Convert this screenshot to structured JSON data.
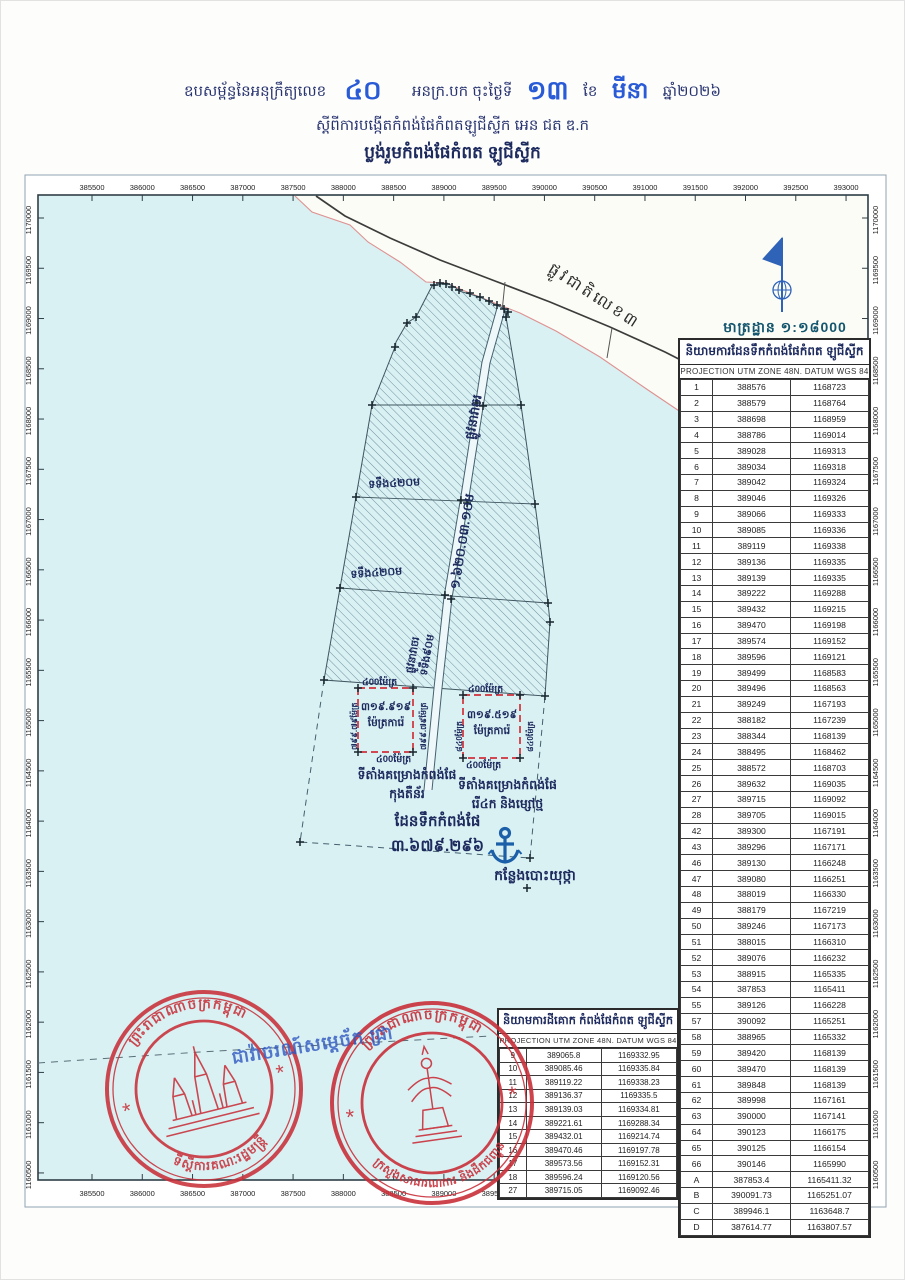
{
  "header": {
    "line1_prefix": "ឧបសម្ព័ន្ធនៃអនុក្រឹត្យលេខ",
    "decree_no": "៤០",
    "line1_mid": "អនក្រ.បក ចុះថ្ងៃទី",
    "day": "១៣",
    "month_label": "ខែ",
    "month": "មីនា",
    "year": "ឆ្នាំ២០២៦",
    "line2": "ស្តីពីការបង្កើតកំពង់ផែកំពតឡូជីស្ទីក អេន ជត ឌ.ក",
    "line3": "ប្លង់រួមកំពង់ផែកំពត ឡូជីស្ទីក"
  },
  "map": {
    "scale_label": "មាត្រដ្ឋាន ១:១៨000",
    "road_label": "ផ្លូវជាតិលេខ៣",
    "channel_label_top": "ផ្លូវនាវាចរ",
    "channel_label_mid": "១.៦២០.០៣.១០ម",
    "channel_label_bottom1": "ផ្លូវនាវាចរ",
    "channel_label_bottom2": "ទទឹង៩០ម",
    "width_label_1": "ទទឹង៤២០ម",
    "width_label_2": "ទទឹង៤២០ម",
    "water_area_line1": "ដែនទឹកកំពង់ផែ",
    "water_area_line2": "៣.៦៧៩.២៩៦",
    "anchorage_label": "កន្លែងបោះយុថ្កា"
  },
  "parcels": {
    "left": {
      "top": "៤00ម៉ែត្រ",
      "bottom": "៤00ម៉ែត្រ",
      "side_left": "៧៩៩.៧៩ម៉ែត្រ",
      "side_right": "៧៩៩.៧៩ម៉ែត្រ",
      "area": "៣១៩.៩១៩",
      "unit": "ម៉ែត្រការ៉េ",
      "caption1": "ទីតាំងគម្រោងកំពង់ផែ",
      "caption2": "កុងតឺន័រ"
    },
    "right": {
      "top": "៤00ម៉ែត្រ",
      "bottom": "៤00ម៉ែត្រ",
      "side_left": "៨៤0ម៉ែត្រ",
      "side_right": "៨៤0ម៉ែត្រ",
      "area": "៣១៩.៥១៩",
      "unit": "ម៉ែត្រការ៉េ",
      "caption1": "ទីតាំងគម្រោងកំពង់ផែ",
      "caption2": "រើ៤ក និងម្សៅថ្ម"
    }
  },
  "water_table": {
    "title": "និយាមការដែនទឹកកំពង់ផែកំពត ឡូជីស្ទីក",
    "subtitle": "PROJECTION UTM ZONE 48N. DATUM WGS 84",
    "rows": [
      [
        "1",
        "388576",
        "1168723"
      ],
      [
        "2",
        "388579",
        "1168764"
      ],
      [
        "3",
        "388698",
        "1168959"
      ],
      [
        "4",
        "388786",
        "1169014"
      ],
      [
        "5",
        "389028",
        "1169313"
      ],
      [
        "6",
        "389034",
        "1169318"
      ],
      [
        "7",
        "389042",
        "1169324"
      ],
      [
        "8",
        "389046",
        "1169326"
      ],
      [
        "9",
        "389066",
        "1169333"
      ],
      [
        "10",
        "389085",
        "1169336"
      ],
      [
        "11",
        "389119",
        "1169338"
      ],
      [
        "12",
        "389136",
        "1169335"
      ],
      [
        "13",
        "389139",
        "1169335"
      ],
      [
        "14",
        "389222",
        "1169288"
      ],
      [
        "15",
        "389432",
        "1169215"
      ],
      [
        "16",
        "389470",
        "1169198"
      ],
      [
        "17",
        "389574",
        "1169152"
      ],
      [
        "18",
        "389596",
        "1169121"
      ],
      [
        "19",
        "389499",
        "1168583"
      ],
      [
        "20",
        "389496",
        "1168563"
      ],
      [
        "21",
        "389249",
        "1167193"
      ],
      [
        "22",
        "388182",
        "1167239"
      ],
      [
        "23",
        "388344",
        "1168139"
      ],
      [
        "24",
        "388495",
        "1168462"
      ],
      [
        "25",
        "388572",
        "1168703"
      ],
      [
        "26",
        "389632",
        "1169035"
      ],
      [
        "27",
        "389715",
        "1169092"
      ],
      [
        "28",
        "389705",
        "1169015"
      ],
      [
        "42",
        "389300",
        "1167191"
      ],
      [
        "43",
        "389296",
        "1167171"
      ],
      [
        "46",
        "389130",
        "1166248"
      ],
      [
        "47",
        "389080",
        "1166251"
      ],
      [
        "48",
        "388019",
        "1166330"
      ],
      [
        "49",
        "388179",
        "1167219"
      ],
      [
        "50",
        "389246",
        "1167173"
      ],
      [
        "51",
        "388015",
        "1166310"
      ],
      [
        "52",
        "389076",
        "1166232"
      ],
      [
        "53",
        "388915",
        "1165335"
      ],
      [
        "54",
        "387853",
        "1165411"
      ],
      [
        "55",
        "389126",
        "1166228"
      ],
      [
        "57",
        "390092",
        "1165251"
      ],
      [
        "58",
        "388965",
        "1165332"
      ],
      [
        "59",
        "389420",
        "1168139"
      ],
      [
        "60",
        "389470",
        "1168139"
      ],
      [
        "61",
        "389848",
        "1168139"
      ],
      [
        "62",
        "389998",
        "1167161"
      ],
      [
        "63",
        "390000",
        "1167141"
      ],
      [
        "64",
        "390123",
        "1166175"
      ],
      [
        "65",
        "390125",
        "1166154"
      ],
      [
        "66",
        "390146",
        "1165990"
      ],
      [
        "A",
        "387853.4",
        "1165411.32"
      ],
      [
        "B",
        "390091.73",
        "1165251.07"
      ],
      [
        "C",
        "389946.1",
        "1163648.7"
      ],
      [
        "D",
        "387614.77",
        "1163807.57"
      ]
    ]
  },
  "land_table": {
    "title": "និយាមការដីគោក កំពង់ផែកំពត ឡូជីស្ទីក",
    "subtitle": "PROJECTION UTM ZONE 48N. DATUM WGS 84",
    "rows": [
      [
        "9",
        "389065.8",
        "1169332.95"
      ],
      [
        "10",
        "389085.46",
        "1169335.84"
      ],
      [
        "11",
        "389119.22",
        "1169338.23"
      ],
      [
        "12",
        "389136.37",
        "1169335.5"
      ],
      [
        "13",
        "389139.03",
        "1169334.81"
      ],
      [
        "14",
        "389221.61",
        "1169288.34"
      ],
      [
        "15",
        "389432.01",
        "1169214.74"
      ],
      [
        "16",
        "389470.46",
        "1169197.78"
      ],
      [
        "17",
        "389573.56",
        "1169152.31"
      ],
      [
        "18",
        "389596.24",
        "1169120.56"
      ],
      [
        "27",
        "389715.05",
        "1169092.46"
      ]
    ]
  },
  "axes": {
    "x_ticks": [
      "385500",
      "386000",
      "386500",
      "387000",
      "387500",
      "388000",
      "388500",
      "389000",
      "389500",
      "390000",
      "390500",
      "391000",
      "391500",
      "392000",
      "392500",
      "393000"
    ],
    "y_ticks": [
      "1170000",
      "1169500",
      "1169000",
      "1168500",
      "1168000",
      "1167500",
      "1167000",
      "1166500",
      "1166000",
      "1165500",
      "1165000",
      "1164500",
      "1164000",
      "1163500",
      "1163000",
      "1162500",
      "1162000",
      "1161500",
      "1161000",
      "1160500"
    ]
  },
  "stamps": {
    "left": {
      "top": "ព្រះរាជាណាចក្រកម្ពុជា",
      "bottom": "ទីស្តីការគណៈរដ្ឋមន្ត្រី",
      "star": "*"
    },
    "right": {
      "top": "ព្រះរាជាណាចក្រកម្ពុជា",
      "bottom": "ក្រសួងសាធារណការ និងដឹកជញ្ជូន",
      "star": "*"
    },
    "blue_note": "ជាវ៉ាចរណ៍សម្តេច័ក ជ្រា"
  },
  "colors": {
    "stamp_red": "#c9303a",
    "ink_blue": "#2a5bd7",
    "navy": "#1d2a5e",
    "teal": "#14566e",
    "water": "#d9f1f3",
    "anchor_blue": "#1b5fa8"
  }
}
